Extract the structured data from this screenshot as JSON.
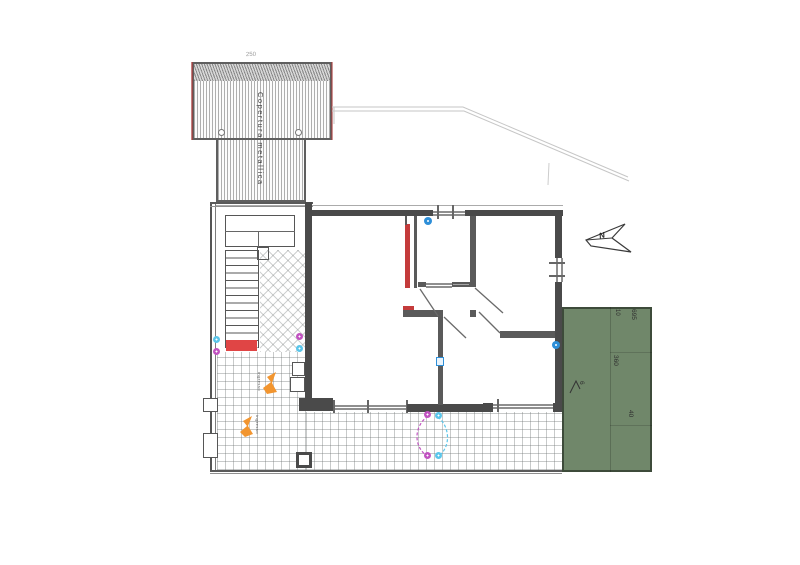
{
  "roof": {
    "label": "Copertura metallica",
    "ridge_dimension": "250"
  },
  "compass": {
    "north_label": "N"
  },
  "garden": {
    "dim_width_total": "695",
    "dim_gap": "10",
    "dim_depth": "360",
    "dim_strip": "40",
    "area_label": "6"
  },
  "entrance_markers": {
    "upper_label": "ingresso",
    "lower_label": "ingresso"
  },
  "colors": {
    "wall": "#4a4a4a",
    "red": "#c43b3b",
    "red-bright": "#e04545",
    "orange": "#f2952f",
    "cyan": "#5bc6ea",
    "magenta": "#c153c1",
    "blue": "#2e8fd8",
    "green": "#70876a",
    "green-border": "#3d4b3a"
  }
}
